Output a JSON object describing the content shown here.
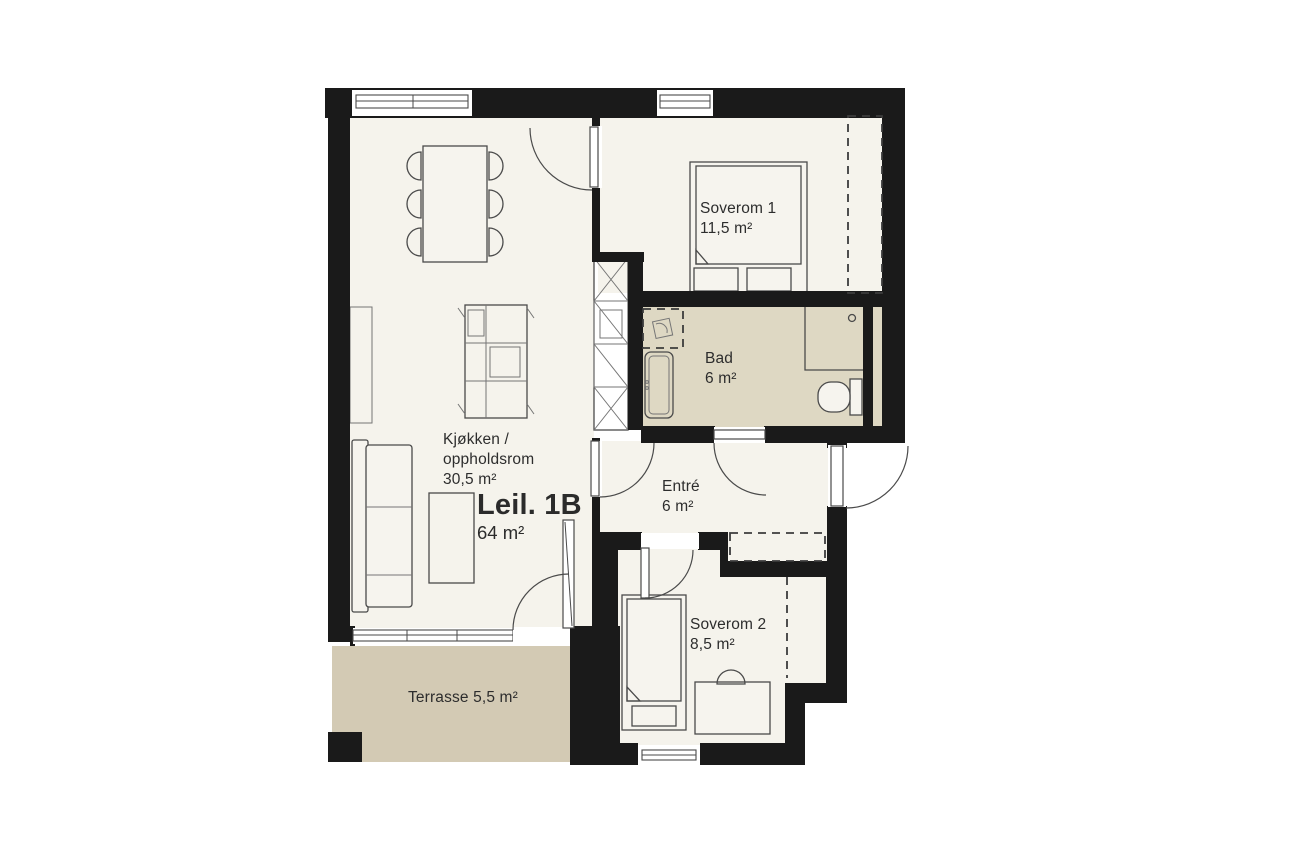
{
  "title": "Floor plan Leil. 1B",
  "apartment": {
    "label": "Leil. 1B",
    "area": "64 m²"
  },
  "rooms": {
    "soverom1": {
      "name": "Soverom 1",
      "area": "11,5 m²"
    },
    "bad": {
      "name": "Bad",
      "area": "6 m²"
    },
    "entre": {
      "name": "Entré",
      "area": "6 m²"
    },
    "soverom2": {
      "name": "Soverom 2",
      "area": "8,5 m²"
    },
    "kitchen": {
      "name_line1": "Kjøkken /",
      "name_line2": "oppholdsrom",
      "area": "30,5 m²"
    },
    "terrace": {
      "label": "Terrasse 5,5 m²"
    }
  },
  "colors": {
    "wall": "#1a1a1a",
    "floor": "#f5f3ec",
    "bathroom_floor": "#ded8c3",
    "terrace_floor": "#d3cab4",
    "text": "#2d2d2d"
  }
}
